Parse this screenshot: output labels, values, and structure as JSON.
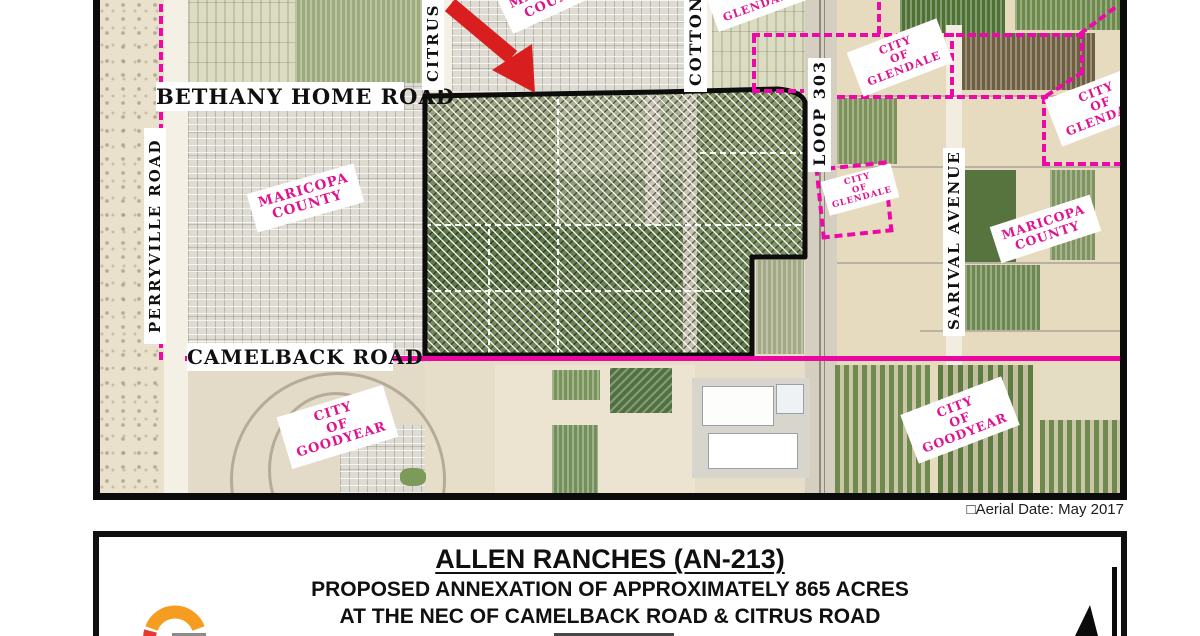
{
  "map": {
    "roads": {
      "bethany": "BETHANY HOME ROAD",
      "camelback": "CAMELBACK ROAD",
      "perryville": "PERRYVILLE ROAD",
      "citrus": "CITRUS ROAD",
      "cotton": "COTTON LANE",
      "loop303": "LOOP 303",
      "sarival": "SARIVAL AVENUE"
    },
    "areas": {
      "maricopa": [
        "MARICOPA",
        "COUNTY"
      ],
      "glendale": [
        "CITY",
        "OF",
        "GLENDALE"
      ],
      "goodyear": [
        "CITY",
        "OF",
        "GOODYEAR"
      ]
    },
    "aerial_date": "□Aerial Date: May 2017",
    "colors": {
      "boundary_magenta": "#ec09a8",
      "annexation_outline": "#0d0d0d",
      "arrow_red": "#d81e1e"
    }
  },
  "title_block": {
    "title": "ALLEN RANCHES (AN-213)",
    "line1": "PROPOSED ANNEXATION OF APPROXIMATELY 865 ACRES",
    "line2": "AT THE NEC OF CAMELBACK ROAD & CITRUS ROAD"
  },
  "icons": {
    "north_arrow": "north-arrow",
    "logo": "city-of-goodyear-g-logo",
    "annex_arrow": "red-arrow"
  }
}
